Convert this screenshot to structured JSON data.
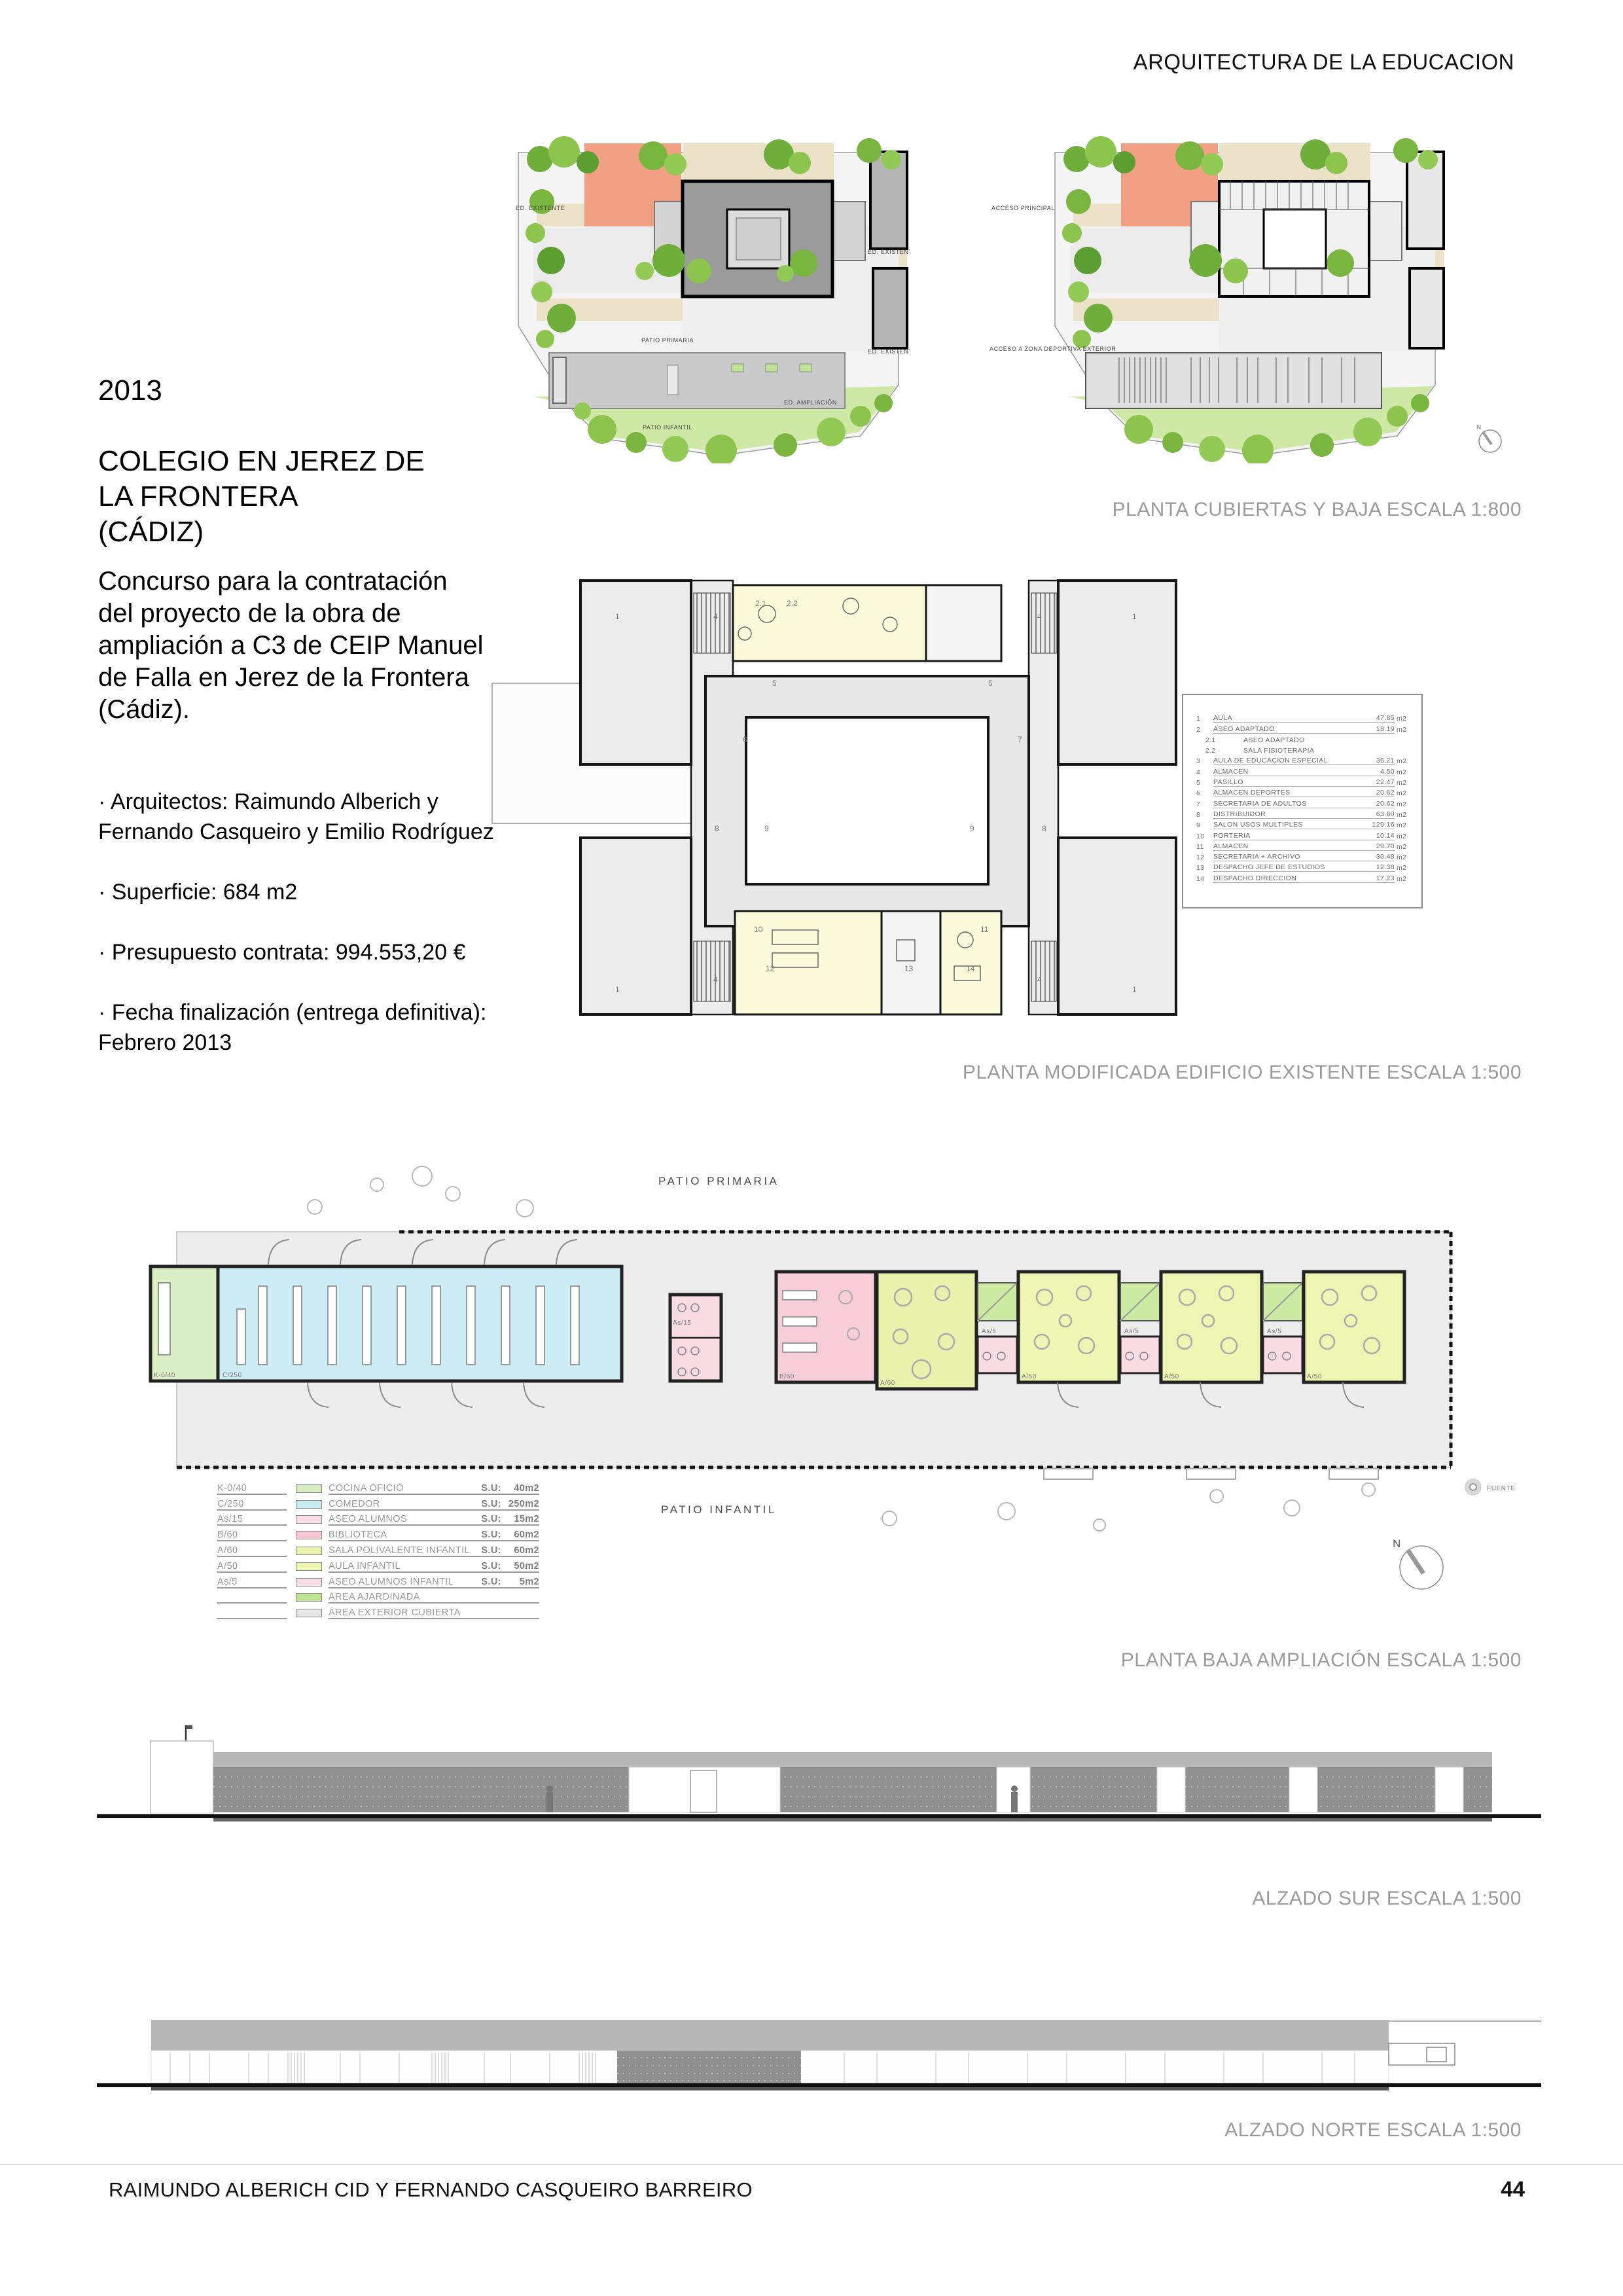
{
  "header": {
    "title": "ARQUITECTURA DE LA EDUCACION"
  },
  "project": {
    "year": "2013",
    "title": "COLEGIO EN JEREZ DE\nLA FRONTERA\n(CÁDIZ)",
    "description": "Concurso para la contratación del proyecto de la obra de ampliación a C3 de CEIP Manuel de Falla en Jerez de la Frontera (Cádiz).",
    "details": [
      "· Arquitectos: Raimundo Alberich y Fernando Casqueiro y Emilio Rodríguez",
      "· Superficie: 684 m2",
      "· Presupuesto contrata: 994.553,20 €",
      "· Fecha finalización (entrega definitiva): Febrero 2013"
    ]
  },
  "captions": {
    "site": "PLANTA CUBIERTAS Y BAJA ESCALA 1:800",
    "existing": "PLANTA MODIFICADA EDIFICIO EXISTENTE ESCALA 1:500",
    "extension": "PLANTA BAJA AMPLIACIÓN ESCALA 1:500",
    "south": "ALZADO SUR ESCALA 1:500",
    "north": "ALZADO NORTE ESCALA 1:500"
  },
  "site_plan": {
    "ed_existente": "ED. EXISTENTE",
    "ed_ampliacion": "ED. AMPLIACIÓN",
    "patio_primaria": "PATIO PRIMARIA",
    "patio_infantil": "PATIO INFANTIL",
    "acceso_principal": "ACCESO PRINCIPAL",
    "acceso_deportiva": "ACCESO A ZONA DEPORTIVA EXTERIOR",
    "north": "N"
  },
  "room_schedule": {
    "unit": "m2",
    "rows": [
      {
        "num": "1",
        "name": "AULA",
        "area": "47.85"
      },
      {
        "num": "2",
        "name": "ASEO ADAPTADO",
        "area": "18.19"
      },
      {
        "num": "2.1",
        "name": "ASEO ADAPTADO",
        "area": ""
      },
      {
        "num": "2.2",
        "name": "SALA FISIOTERAPIA",
        "area": ""
      },
      {
        "num": "3",
        "name": "AULA DE EDUCACION ESPECIAL",
        "area": "36.21"
      },
      {
        "num": "4",
        "name": "ALMACEN",
        "area": "4.50"
      },
      {
        "num": "5",
        "name": "PASILLO",
        "area": "22.47"
      },
      {
        "num": "6",
        "name": "ALMACEN DEPORTES",
        "area": "20.62"
      },
      {
        "num": "7",
        "name": "SECRETARIA DE ADULTOS",
        "area": "20.62"
      },
      {
        "num": "8",
        "name": "DISTRIBUIDOR",
        "area": "63.80"
      },
      {
        "num": "9",
        "name": "SALON USOS MULTIPLES",
        "area": "129.16"
      },
      {
        "num": "10",
        "name": "PORTERIA",
        "area": "10.14"
      },
      {
        "num": "11",
        "name": "ALMACEN",
        "area": "29.70"
      },
      {
        "num": "12",
        "name": "SECRETARIA + ARCHIVO",
        "area": "30.48"
      },
      {
        "num": "13",
        "name": "DESPACHO JEFE DE ESTUDIOS",
        "area": "12.38"
      },
      {
        "num": "14",
        "name": "DESPACHO DIRECCION",
        "area": "17.23"
      }
    ]
  },
  "extension_plan": {
    "labels": {
      "kitchen": "K-0/40",
      "comedor": "C/250",
      "aseo": "As/15",
      "biblioteca": "B/60",
      "sala": "A/60",
      "aseo_inf": "As/5",
      "aula": "A/50",
      "patio_primaria": "PATIO PRIMARIA",
      "patio_infantil": "PATIO INFANTIL",
      "fuente": "FUENTE",
      "north": "N"
    }
  },
  "legend": {
    "rows": [
      {
        "code": "K-0/40",
        "color": "#d6edc1",
        "name": "COCINA OFICIO",
        "su": "S.U:",
        "area": "40m2"
      },
      {
        "code": "C/250",
        "color": "#c9e9f3",
        "name": "COMEDOR",
        "su": "S.U:",
        "area": "250m2"
      },
      {
        "code": "As/15",
        "color": "#fadde4",
        "name": "ASEO ALUMNOS",
        "su": "S.U:",
        "area": "15m2"
      },
      {
        "code": "B/60",
        "color": "#f8c9d4",
        "name": "BIBLIOTECA",
        "su": "S.U:",
        "area": "60m2"
      },
      {
        "code": "A/60",
        "color": "#ebf2ae",
        "name": "SALA POLIVALENTE INFANTIL",
        "su": "S.U:",
        "area": "60m2"
      },
      {
        "code": "A/50",
        "color": "#eff4b3",
        "name": "AULA INFANTIL",
        "su": "S.U:",
        "area": "50m2"
      },
      {
        "code": "As/5",
        "color": "#fadde4",
        "name": "ASEO ALUMNOS INFANTIL",
        "su": "S.U:",
        "area": "5m2"
      },
      {
        "code": "",
        "color": "#bfe394",
        "name": "ÁREA AJARDINADA",
        "su": "",
        "area": ""
      },
      {
        "code": "",
        "color": "#e6e6e6",
        "name": "ÁREA EXTERIOR CUBIERTA",
        "su": "",
        "area": ""
      }
    ]
  },
  "footer": {
    "authors": "RAIMUNDO ALBERICH CID Y FERNANDO CASQUEIRO BARREIRO",
    "page": "44"
  }
}
